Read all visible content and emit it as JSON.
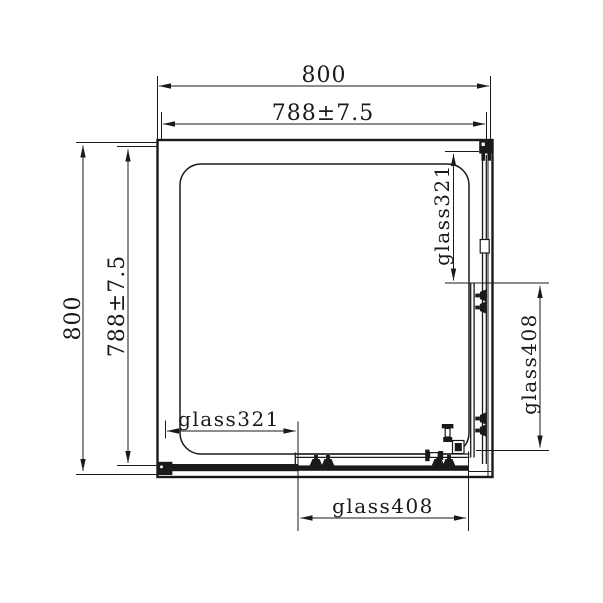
{
  "drawing": {
    "type": "technical-plan-shower-enclosure",
    "line_color": "#1a1a1a",
    "background_color": "#ffffff",
    "labels": {
      "overall_width": "800",
      "inner_width": "788±7.5",
      "overall_height": "800",
      "inner_height": "788±7.5",
      "right_fixed_glass": "glass321",
      "right_door_glass": "glass408",
      "bottom_fixed_glass": "glass321",
      "bottom_door_glass": "glass408"
    }
  }
}
